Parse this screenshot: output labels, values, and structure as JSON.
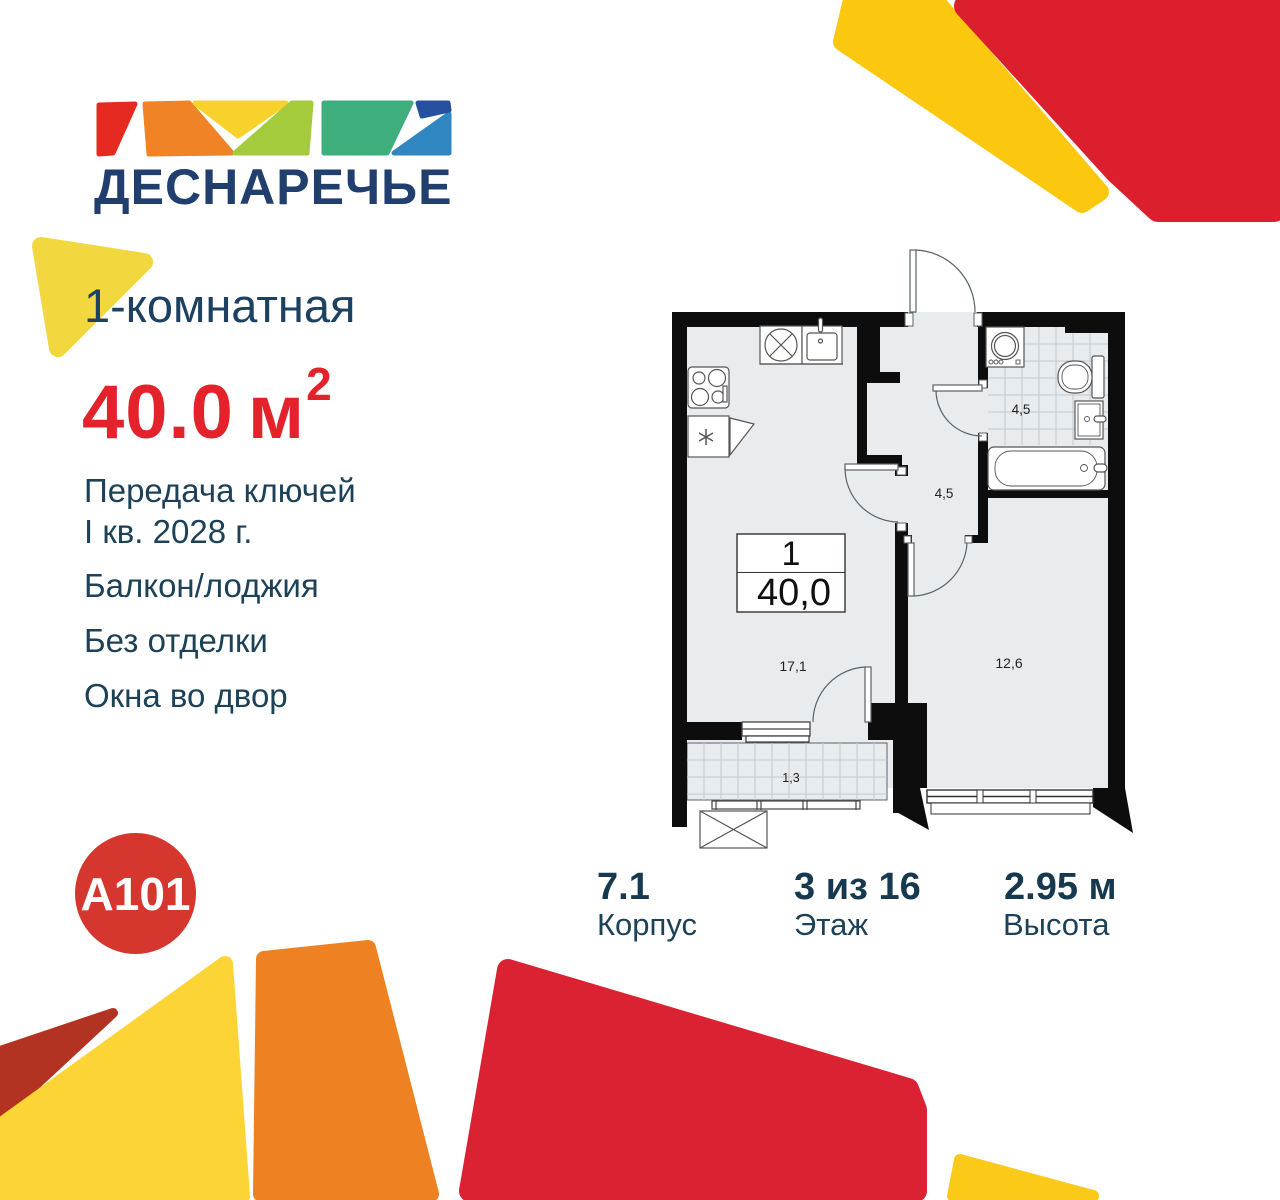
{
  "colors": {
    "navy_text": "#1d4156",
    "logo_navy": "#203e6e",
    "accent_red": "#e3222c",
    "a101_red": "#d5372e",
    "decor_red_top": "#dc1f2d",
    "decor_red_bottom": "#da2232",
    "decor_dark_red": "#b23322",
    "decor_yellow": "#fcd435",
    "decor_soft_yellow": "#f2d73e",
    "decor_orange": "#ee8122",
    "plan_wall": "#0d0d0d",
    "plan_floor": "#e8ecef"
  },
  "logo": {
    "name": "ДЕСНАРЕЧЬЕ"
  },
  "developer": {
    "name": "A101"
  },
  "listing": {
    "title": "1-комнатная",
    "area_value": "40.0",
    "area_unit": "м",
    "area_exponent": "2",
    "features": [
      [
        "Передача ключей",
        "I кв. 2028 г."
      ],
      [
        "Балкон/лоджия"
      ],
      [
        "Без отделки"
      ],
      [
        "Окна во двор"
      ]
    ]
  },
  "plan": {
    "rooms_count": "1",
    "total_area": "40,0",
    "labels": {
      "kitchen_living": "17,1",
      "bedroom": "12,6",
      "hallway": "4,5",
      "bathroom": "4,5",
      "balcony": "1,3"
    }
  },
  "details": [
    {
      "value": "7.1",
      "label": "Корпус"
    },
    {
      "value": "3 из 16",
      "label": "Этаж"
    },
    {
      "value": "2.95 м",
      "label": "Высота"
    }
  ]
}
